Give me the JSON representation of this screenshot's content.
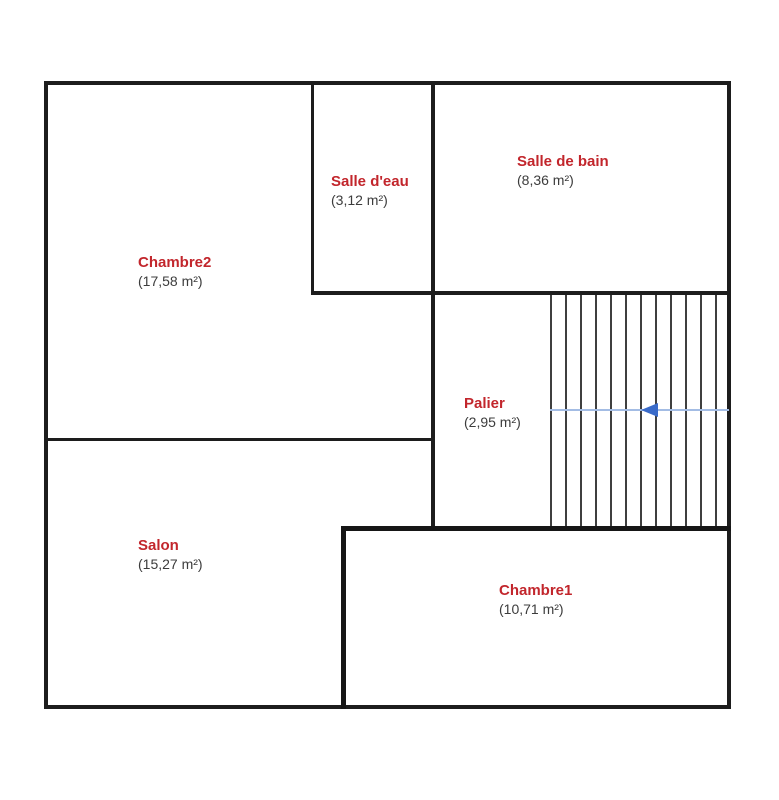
{
  "plan": {
    "title": "floor-plan",
    "rooms": [
      {
        "id": "chambre2",
        "name": "Chambre2",
        "area": "(17,58 m²)"
      },
      {
        "id": "salle-deau",
        "name": "Salle d'eau",
        "area": "(3,12 m²)"
      },
      {
        "id": "salle-de-bain",
        "name": "Salle de bain",
        "area": "(8,36 m²)"
      },
      {
        "id": "palier",
        "name": "Palier",
        "area": "(2,95 m²)"
      },
      {
        "id": "salon",
        "name": "Salon",
        "area": "(15,27 m²)"
      },
      {
        "id": "chambre1",
        "name": "Chambre1",
        "area": "(10,71 m²)"
      }
    ],
    "stairs": {
      "tread_count": 13,
      "direction_arrow": "left"
    },
    "colors": {
      "room_name": "#c2262c",
      "room_area": "#3c3c3c",
      "wall": "#1d1d1d",
      "stair_line": "#3f3f3f",
      "arrow": "#3a6bc9",
      "arrow_line": "#a3bce4"
    }
  }
}
